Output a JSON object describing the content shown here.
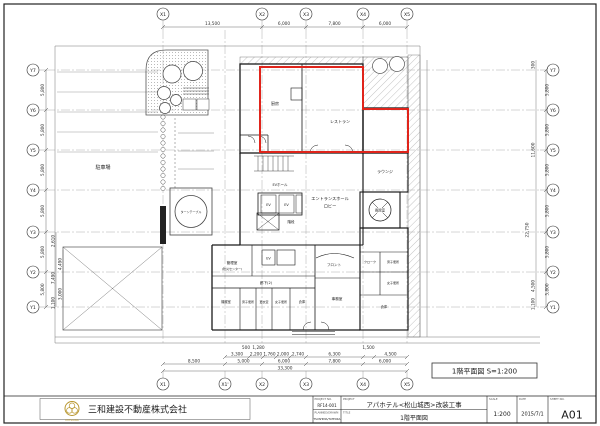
{
  "sheet": {
    "legend": "1階平面図 S=1:200",
    "company": {
      "name": "三和建設不動産株式会社",
      "mark": "MITSUWA"
    },
    "title_block": {
      "project_no_label": "PROJECT NO.",
      "project_no": "RF14-001",
      "planned_label": "PLANNED/DRAWN",
      "planned": "TSUSHIMA/TATEOKA",
      "project_label": "PROJECT",
      "project": "アパホテル<松山城西>改装工事",
      "title_label": "TITLE",
      "title": "1階平面図",
      "scale_label": "SCALE",
      "scale": "1:200",
      "date_label": "DATE",
      "date": "2015/7/1",
      "sheet_label": "SHEET NO.",
      "sheet_no": "A01"
    },
    "grid": {
      "x_top": [
        "X1",
        "X2",
        "X3",
        "X4",
        "X5"
      ],
      "x_bottom": [
        "X1",
        "X1'",
        "X2",
        "X3",
        "X4",
        "X5"
      ],
      "y_left": [
        "Y7",
        "Y6",
        "Y5",
        "Y4",
        "Y3",
        "Y2",
        "Y1"
      ],
      "y_right": [
        "Y7",
        "Y6",
        "Y5",
        "Y4",
        "Y3",
        "Y2",
        "Y1"
      ]
    },
    "dims": {
      "top": [
        "13,500",
        "6,000",
        "7,800",
        "6,000"
      ],
      "bottom_small": [
        "500",
        "1,280",
        "1,500"
      ],
      "bottom_row1": [
        "3,300",
        "2,200",
        "1,760",
        "2,000",
        "2,740",
        "6,300",
        "4,500"
      ],
      "bottom_row2": [
        "8,500",
        "5,000",
        "6,000",
        "7,800",
        "6,000"
      ],
      "bottom_total": "33,300",
      "left": [
        "5,800",
        "5,800",
        "5,800",
        "5,800",
        "5,800",
        "5,800"
      ],
      "left_inner": [
        "2,610",
        "4,490",
        "7,490",
        "3,000",
        "1,100"
      ],
      "right": [
        "5,800",
        "5,800",
        "5,800",
        "5,800",
        "5,800",
        "5,800"
      ],
      "right_inner": [
        "300",
        "11,600",
        "22,750",
        "4,500",
        "1,100"
      ]
    },
    "rooms": {
      "kitchen": "厨房",
      "restaurant": "レストラン",
      "lounge": "ラウンジ",
      "windbreak": "風除室",
      "entrance_hall": "エントランスホール",
      "lobby": "ロビー",
      "ev_hall": "EVホール",
      "ev": "EV",
      "stairs": "階段",
      "admin": "管理室",
      "admin_sub": "(防災センター)",
      "corridor": "廊下(2)",
      "machine": "機械室",
      "mens_wc": "男子便所",
      "changing": "更衣室",
      "womens_wc": "女子便所",
      "storage": "倉庫",
      "front": "フロント",
      "office": "事務室",
      "cloak": "クローク",
      "parking": "駐車場",
      "turntable": "ターンテーブル"
    }
  }
}
